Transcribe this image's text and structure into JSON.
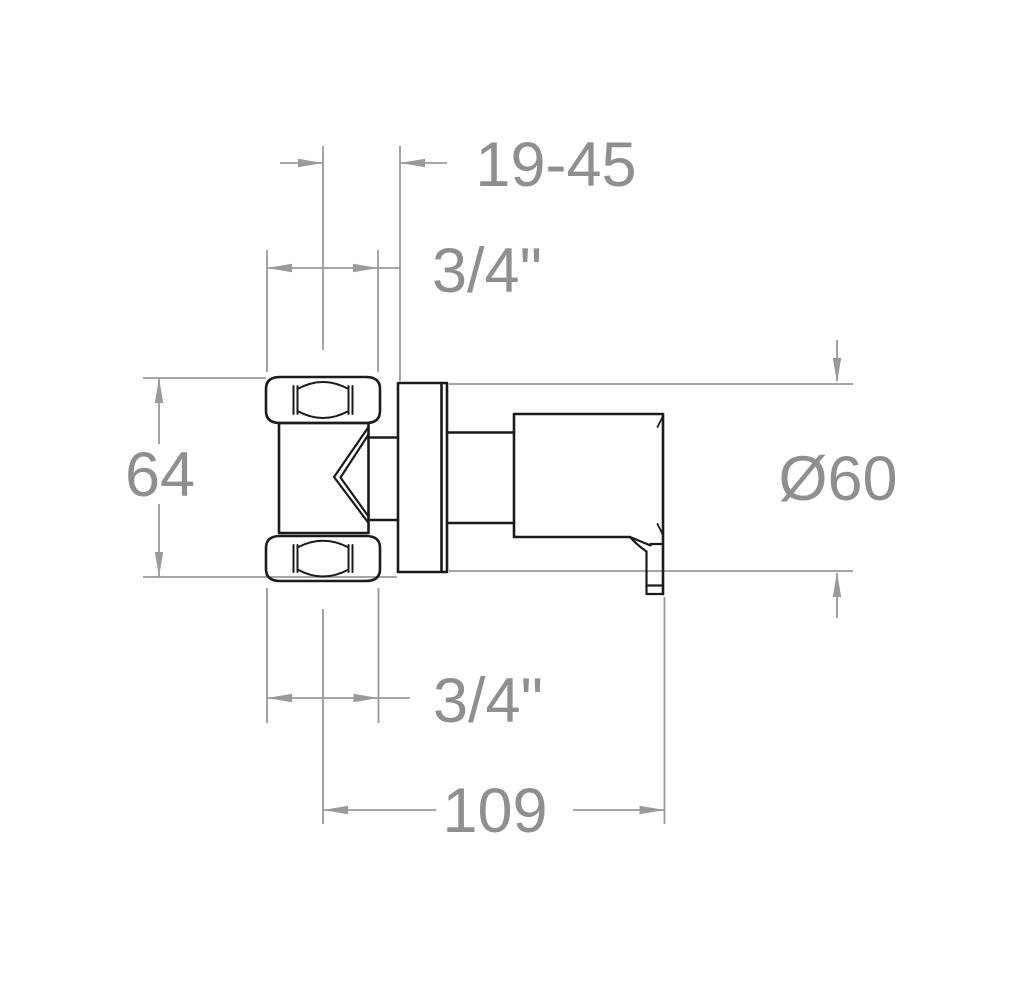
{
  "title": "Wall-mounted valve technical dimension drawing",
  "colors": {
    "background": "#ffffff",
    "drawing": "#1b1b1b",
    "dimension": "#9a9a9a",
    "label": "#8f8f8f"
  },
  "dimensions": {
    "embedment_depth": "19-45",
    "inlet_thread": "3/4\"",
    "body_height": "64",
    "handle_diameter": "Ø60",
    "outlet_thread": "3/4\"",
    "total_depth": "109"
  }
}
